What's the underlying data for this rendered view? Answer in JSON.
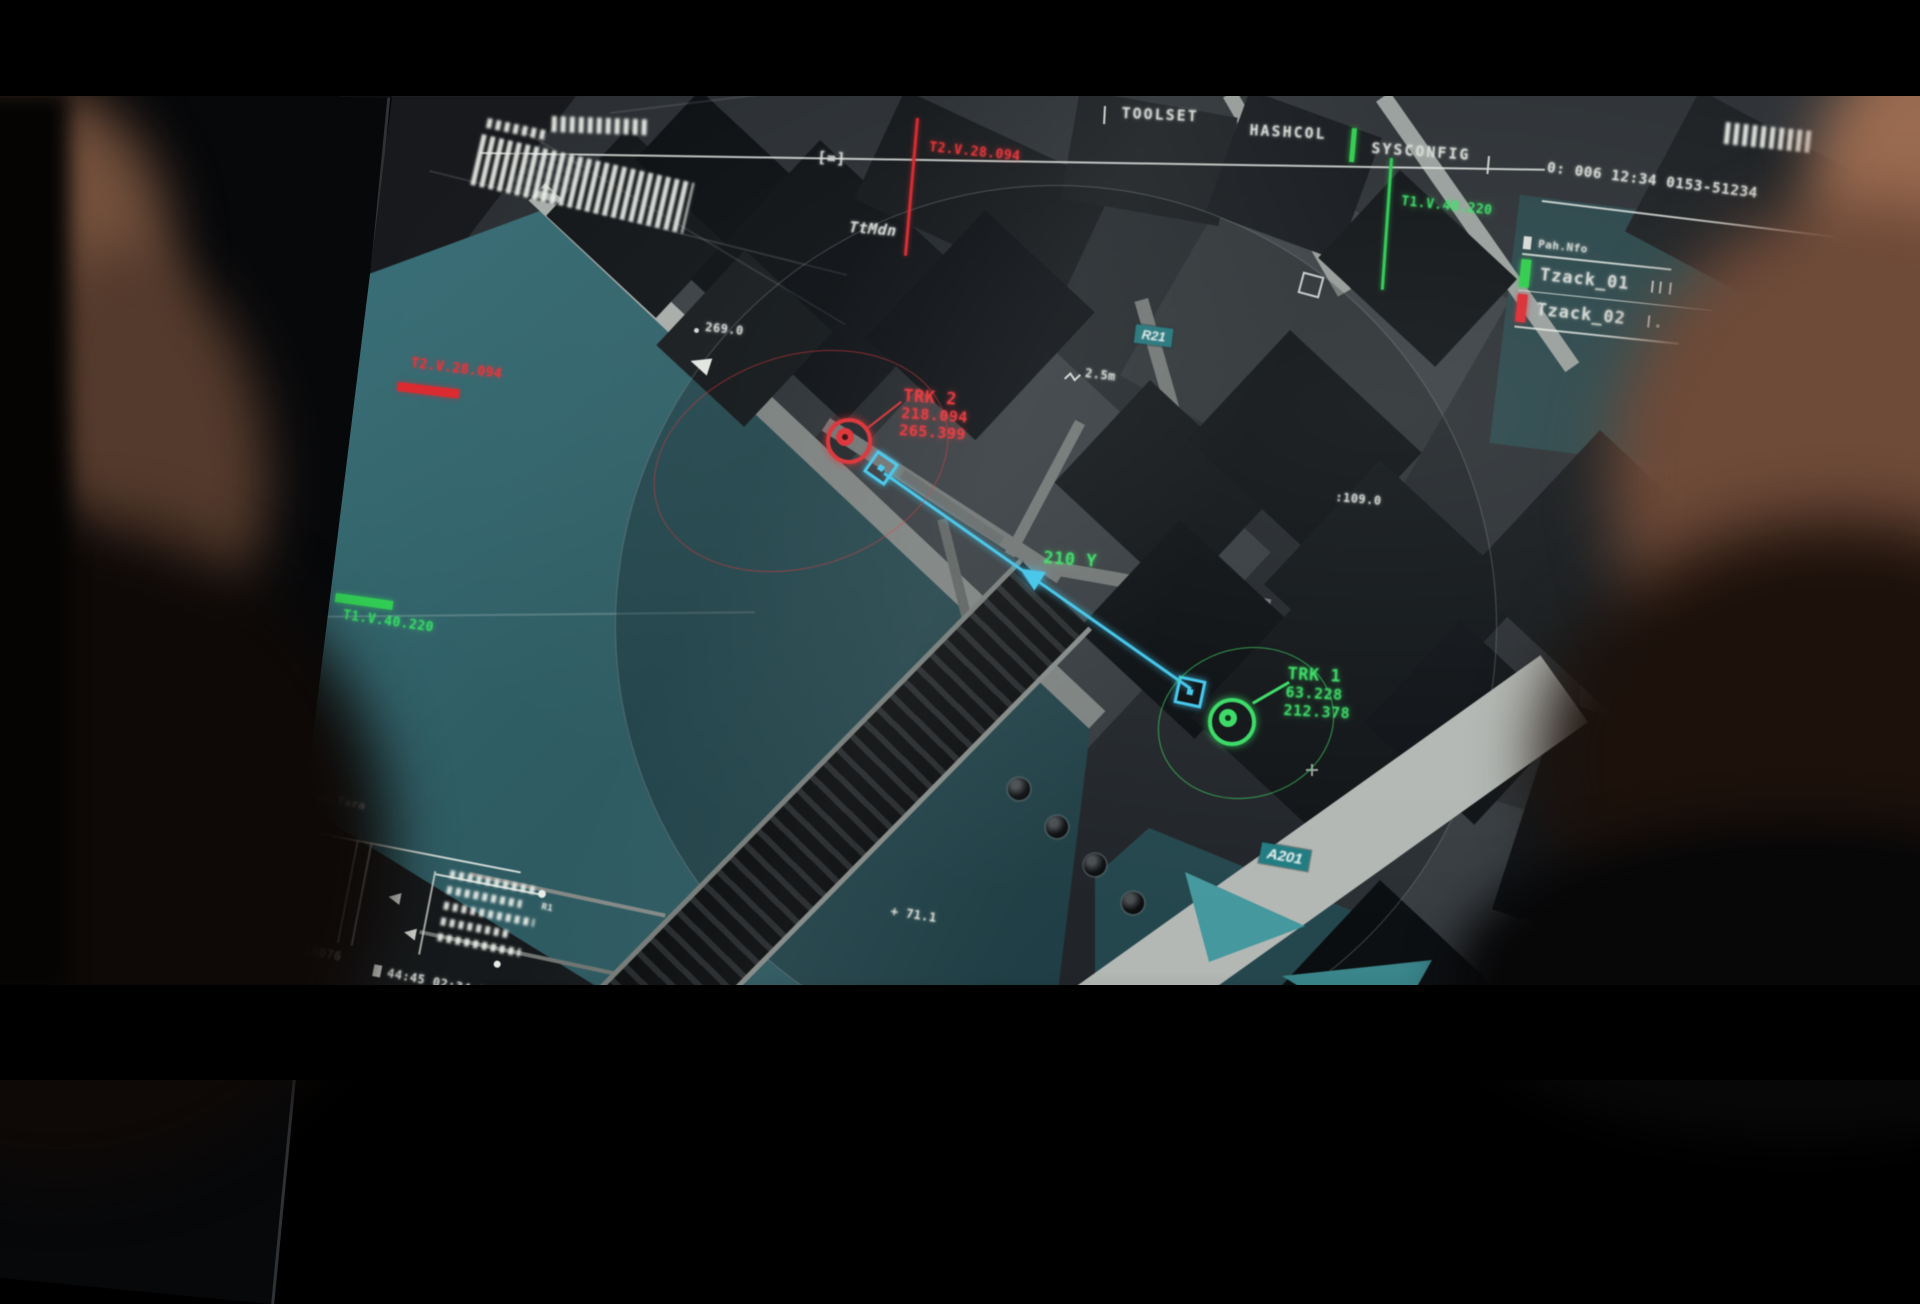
{
  "topbar": {
    "menu": [
      {
        "label": "TOOLSET"
      },
      {
        "label": "HASHCOL"
      },
      {
        "label": "SYSCONFIG"
      }
    ],
    "status": "0: 006  12:34 0153-51234"
  },
  "legend": {
    "header": "Pah.Nfo",
    "items": [
      {
        "label": "Tzack_01",
        "color": "#23d243"
      },
      {
        "label": "Tzack_02",
        "color": "#e8262c"
      }
    ]
  },
  "tracks": {
    "trk1": {
      "label": "TRK 1",
      "val1": "63.228",
      "val2": "212.378",
      "color": "#2ee55e"
    },
    "trk2": {
      "label": "TRK 2",
      "val1": "218.094",
      "val2": "265.399",
      "color": "#ff2b31"
    },
    "bearing": "210 Y"
  },
  "telemetry": {
    "top_red": "T2.V.28.094",
    "top_green": "T1.V.40.220",
    "left_red": "T2.V.28.094",
    "left_green": "T1.V.40.220"
  },
  "map_labels": {
    "district": "TtMdn",
    "road_badge_1": "R21",
    "road_badge_2": "A201",
    "elevation_1": "269.0",
    "elevation_2": "+ 71.1",
    "scale": "2.5m",
    "marker_time": ":109.0",
    "ref_point": "R1",
    "bracket_glyph": "[=]"
  },
  "datablock": {
    "header": "Pah.Tara",
    "value_left": "4394:59076",
    "value_right": "44:45 02:34:24"
  },
  "colors": {
    "water": "#2d5e63",
    "red": "#e8262c",
    "green": "#23d243",
    "cyan": "#35c8f1",
    "badge_teal": "#17737a"
  }
}
